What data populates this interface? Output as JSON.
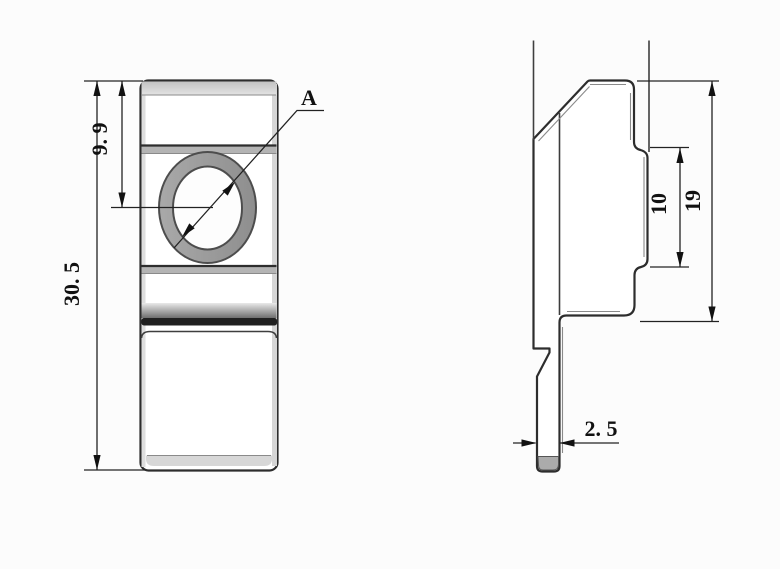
{
  "drawing": {
    "type": "engineering-drawing",
    "background": "#fcfcfc",
    "line_color": "#2d2d2d",
    "dim_color": "#111111",
    "ring_fill": "#9b9b9b",
    "band_fill": "#b4b4b4",
    "dark_band_fill": "#202020",
    "front_view": {
      "dim_total_height": "30. 5",
      "dim_hole_offset": "9. 9",
      "hole_label": "A"
    },
    "side_view": {
      "dim_face_height": "19",
      "dim_step_height": "10",
      "dim_thickness": "2. 5"
    }
  }
}
